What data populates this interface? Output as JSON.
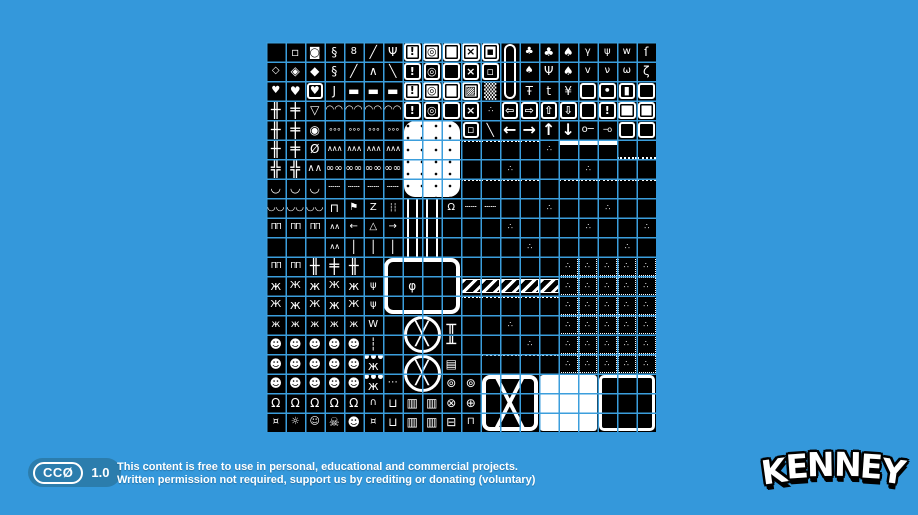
{
  "page": {
    "background_color": "#3498db",
    "sheet_black": "#000000",
    "sheet_white": "#ffffff",
    "gridline_color": "#3b9edc",
    "badge_color": "#2b7dad"
  },
  "license": {
    "badge_cc": "CCØ",
    "badge_version": "1.0",
    "line1": "This content is free to use in personal, educational and commercial projects.",
    "line2": "Written permission not required, support us by crediting or donating (voluntary)"
  },
  "logo": {
    "text": "KENNEY"
  },
  "tilesheet": {
    "description": "1-bit monochrome game tilesheet preview, 20x20 tiles, white pixel art on black with blue grid overlay",
    "grid": {
      "cols": 20,
      "rows": 20,
      "pitch_px": 19.5
    },
    "cross_glyph": "╳",
    "legend": {
      "sq": {
        "ch": "▫"
      },
      "coin": {
        "ch": "◙"
      },
      "chain": {
        "ch": "§"
      },
      "chain2": {
        "ch": "8",
        "cls": "s"
      },
      "ropeL": {
        "ch": "╱"
      },
      "claw": {
        "ch": "Ψ"
      },
      "fwEx": {
        "ch": "!",
        "cls": "fw"
      },
      "fwGear": {
        "ch": "◎",
        "cls": "fw"
      },
      "fwBk": {
        "cls": "fw"
      },
      "fxw": {
        "ch": "×",
        "cls": "fw"
      },
      "fsqW": {
        "ch": "▪",
        "cls": "fw"
      },
      "fbEx": {
        "ch": "!",
        "cls": "fb"
      },
      "fbGear": {
        "ch": "◎",
        "cls": "fb"
      },
      "fbBk": {
        "cls": "fb"
      },
      "fxb": {
        "ch": "×",
        "cls": "fb"
      },
      "fsqB": {
        "ch": "▫",
        "cls": "fb"
      },
      "fhatch": {
        "ch": "▨",
        "cls": "fw"
      },
      "dith": {
        "ch": "▒",
        "cls": "big"
      },
      "capT": {
        "cls": "capt"
      },
      "capM": {
        "cls": "capm"
      },
      "capBt": {
        "cls": "capb"
      },
      "bush": {
        "ch": "♣",
        "cls": "s"
      },
      "treeR": {
        "ch": "♣"
      },
      "treeP": {
        "ch": "♠"
      },
      "pine": {
        "ch": "♠",
        "cls": "s"
      },
      "treeB": {
        "ch": "Ψ"
      },
      "treeT": {
        "ch": "♠"
      },
      "treeD": {
        "ch": "¥"
      },
      "pl1": {
        "ch": "γ",
        "cls": "s"
      },
      "pl2": {
        "ch": "ψ",
        "cls": "s"
      },
      "pl3": {
        "ch": "v",
        "cls": "s"
      },
      "pl4": {
        "ch": "ν",
        "cls": "s"
      },
      "grass": {
        "ch": "w",
        "cls": "s"
      },
      "grass2": {
        "ch": "ω",
        "cls": "s"
      },
      "sap": {
        "ch": "ſ"
      },
      "vine": {
        "ch": "ζ"
      },
      "dia1": {
        "ch": "◇",
        "cls": "s"
      },
      "dia2": {
        "ch": "◈"
      },
      "dia3": {
        "ch": "◆"
      },
      "trusL": {
        "ch": "╱"
      },
      "trusA": {
        "ch": "∧"
      },
      "trusR": {
        "ch": "╲"
      },
      "hrt1": {
        "ch": "♥",
        "cls": "s"
      },
      "hrt2": {
        "ch": "♥"
      },
      "hrt3": {
        "ch": "♥",
        "cls": "fb s"
      },
      "hook": {
        "ch": "J"
      },
      "beam": {
        "ch": "▬"
      },
      "mushT": {
        "ch": "Ŧ"
      },
      "mush": {
        "ch": "t"
      },
      "door": {
        "cls": "fb"
      },
      "doorK": {
        "ch": "•",
        "cls": "fb"
      },
      "doorO": {
        "ch": "▮",
        "cls": "fb s"
      },
      "doorW": {
        "cls": "fb"
      },
      "lad": {
        "ch": "╫",
        "cls": "big"
      },
      "lad2": {
        "ch": "╪",
        "cls": "big"
      },
      "ladB": {
        "ch": "╬",
        "cls": "big"
      },
      "gemD": {
        "ch": "▽"
      },
      "gemO": {
        "ch": "◉"
      },
      "gem0": {
        "ch": "Ø"
      },
      "scalT": {
        "ch": "◠◠",
        "cls": "s"
      },
      "balls": {
        "ch": "∘∘∘",
        "cls": "xs"
      },
      "zig": {
        "ch": "∧∧∧",
        "cls": "xs"
      },
      "oval": {
        "ch": "∞∞",
        "cls": "s"
      },
      "dotln": {
        "ch": "┄┄",
        "cls": "s"
      },
      "scalB": {
        "ch": "◡◡",
        "cls": "s"
      },
      "curve": {
        "ch": "◡"
      },
      "spkM": {
        "ch": "∧∧",
        "cls": "s"
      },
      "spkl": {
        "ch": "∴",
        "cls": "xs"
      },
      "diag": {
        "ch": "╲"
      },
      "signL": {
        "ch": "⇦",
        "cls": "fb"
      },
      "signR": {
        "ch": "⇨",
        "cls": "fb"
      },
      "signU": {
        "ch": "⇧",
        "cls": "fb"
      },
      "signD": {
        "ch": "⇩",
        "cls": "fb"
      },
      "signB": {
        "cls": "fb"
      },
      "signE": {
        "ch": "!",
        "cls": "fb"
      },
      "win": {
        "cls": "fw"
      },
      "arL": {
        "ch": "←",
        "cls": "big"
      },
      "arR": {
        "ch": "→",
        "cls": "big"
      },
      "arU": {
        "ch": "↑",
        "cls": "big"
      },
      "arD": {
        "ch": "↓",
        "cls": "big"
      },
      "key": {
        "ch": "o─",
        "cls": "s"
      },
      "key2": {
        "ch": "─o",
        "cls": "xs"
      },
      "frT": {
        "cls": "fb"
      },
      "sill": {
        "cls": "sill"
      },
      "dt": {
        "cls": "dt"
      },
      "topW": {
        "cls": "topw"
      },
      "haz": {
        "cls": "haz"
      },
      "ore": {
        "ch": "∴",
        "cls": "ore"
      },
      "plat": {
        "ch": "⊓"
      },
      "flag": {
        "ch": "⚑",
        "cls": "s"
      },
      "zplat": {
        "ch": "Z",
        "cls": "s"
      },
      "icic": {
        "ch": "┆┆",
        "cls": "xs"
      },
      "pv": {
        "cls": "pv"
      },
      "bell": {
        "ch": "Ω",
        "cls": "s"
      },
      "fence": {
        "ch": "ΠΠ",
        "cls": "xs"
      },
      "spike": {
        "ch": "∧∧",
        "cls": "xs"
      },
      "signA": {
        "ch": "←",
        "cls": "s"
      },
      "wsign": {
        "ch": "△",
        "cls": "s"
      },
      "signA2": {
        "ch": "→",
        "cls": "s"
      },
      "post": {
        "ch": "│"
      },
      "ptl": {
        "cls": "ptl"
      },
      "pt": {
        "cls": "pt"
      },
      "ptr": {
        "cls": "ptr"
      },
      "pl_": {
        "cls": "psl"
      },
      "pr_": {
        "cls": "psr"
      },
      "pbl": {
        "cls": "pbl"
      },
      "pb": {
        "cls": "pb"
      },
      "pbr": {
        "cls": "pbr"
      },
      "lamp": {
        "ch": "φ"
      },
      "flange": {
        "ch": "╥",
        "cls": "big"
      },
      "flange2": {
        "ch": "╨",
        "cls": "big"
      },
      "sp1": {
        "ch": "ж"
      },
      "sp2": {
        "ch": "Ж",
        "cls": "s"
      },
      "sp3": {
        "ch": "ж",
        "cls": "s"
      },
      "crab": {
        "ch": "ψ",
        "cls": "s"
      },
      "bat": {
        "ch": "W",
        "cls": "s"
      },
      "skull": {
        "ch": "☻"
      },
      "thread": {
        "ch": "┆"
      },
      "jsp": {
        "ch": "ж",
        "cls": "thr"
      },
      "dots3": {
        "ch": "⋯",
        "cls": "s"
      },
      "burger": {
        "ch": "Ω"
      },
      "mound": {
        "ch": "∩",
        "cls": "s"
      },
      "basket": {
        "ch": "⊔"
      },
      "grate": {
        "ch": "▥"
      },
      "wheelX": {
        "ch": "⊗"
      },
      "wheelO": {
        "ch": "⊕"
      },
      "elbow": {
        "ch": "⊚"
      },
      "chest": {
        "ch": "⊟"
      },
      "tabl": {
        "ch": "⊓",
        "cls": "s"
      },
      "vent": {
        "ch": "▤"
      },
      "bug": {
        "ch": "¤",
        "cls": "s"
      },
      "bug2": {
        "ch": "☼",
        "cls": "s"
      },
      "face": {
        "ch": "☺",
        "cls": "s"
      },
      "bones": {
        "ch": "☠"
      },
      "cart": {
        "ch": "⊔"
      }
    },
    "map": [
      [
        "",
        "sq",
        "coin",
        "chain",
        "chain2",
        "ropeL",
        "claw",
        "fwEx",
        "fwGear",
        "fwBk",
        "fxw",
        "fsqW",
        "capT",
        "bush",
        "treeR",
        "treeP",
        "pl1",
        "pl2",
        "grass",
        "sap"
      ],
      [
        "dia1",
        "dia2",
        "dia3",
        "chain",
        "trusL",
        "trusA",
        "trusR",
        "fbEx",
        "fbGear",
        "fbBk",
        "fxb",
        "fsqB",
        "capM",
        "pine",
        "treeB",
        "treeT",
        "pl3",
        "pl4",
        "grass2",
        "vine"
      ],
      [
        "hrt1",
        "hrt2",
        "hrt3",
        "hook",
        "beam",
        "beam",
        "beam",
        "fwEx",
        "fwGear",
        "fwBk",
        "fhatch",
        "dith",
        "capBt",
        "mushT",
        "mush",
        "treeD",
        "door",
        "doorK",
        "doorO",
        "doorW"
      ],
      [
        "lad",
        "lad2",
        "gemD",
        "scalT",
        "scalT",
        "scalT",
        "scalT",
        "fbEx",
        "fbGear",
        "fbBk",
        "fxb",
        "spkl",
        "signL",
        "signR",
        "signU",
        "signD",
        "signB",
        "signE",
        "win",
        "win"
      ],
      [
        "lad",
        "lad2",
        "gemO",
        "balls",
        "balls",
        "balls",
        "balls",
        "",
        "",
        "",
        "fsqB",
        "diag",
        "arL",
        "arR",
        "arU",
        "arD",
        "key",
        "key2",
        "frT",
        "frT"
      ],
      [
        "lad",
        "lad2",
        "gem0",
        "zig",
        "zig",
        "zig",
        "zig",
        "",
        "",
        "",
        "dt",
        "dt",
        "dt",
        "dt",
        "spkl",
        "topW",
        "topW",
        "topW",
        "sill",
        "sill"
      ],
      [
        "ladB",
        "ladB",
        "spkM",
        "oval",
        "oval",
        "oval",
        "oval",
        "",
        "",
        "",
        "",
        "",
        "spkl",
        "",
        "",
        "",
        "spkl",
        "",
        "",
        ""
      ],
      [
        "curve",
        "curve",
        "curve",
        "dotln",
        "dotln",
        "dotln",
        "dotln",
        "",
        "",
        "",
        "dt",
        "dt",
        "dt",
        "dt",
        "",
        "dt",
        "dt",
        "dt",
        "dt",
        "dt"
      ],
      [
        "scalB",
        "scalB",
        "scalB",
        "plat",
        "flag",
        "zplat",
        "icic",
        "pv",
        "pv",
        "bell",
        "dotln",
        "dotln",
        "",
        "",
        "spkl",
        "",
        "",
        "spkl",
        "",
        ""
      ],
      [
        "fence",
        "fence",
        "fence",
        "spike",
        "signA",
        "wsign",
        "signA2",
        "pv",
        "pv",
        "",
        "",
        "",
        "spkl",
        "",
        "",
        "",
        "spkl",
        "",
        "",
        "spkl"
      ],
      [
        "",
        "",
        "",
        "spike",
        "post",
        "post",
        "post",
        "pv",
        "pv",
        "",
        "",
        "",
        "",
        "spkl",
        "",
        "",
        "",
        "",
        "spkl",
        ""
      ],
      [
        "fence",
        "fence",
        "lad",
        "lad2",
        "lad",
        "",
        "ptl",
        "pt",
        "pt",
        "ptr",
        "",
        "",
        "",
        "",
        "",
        "ore",
        "ore",
        "ore",
        "ore",
        "ore"
      ],
      [
        "sp1",
        "sp2",
        "sp1",
        "sp2",
        "sp1",
        "crab",
        "pl_",
        "lamp",
        "",
        "pr_",
        "haz",
        "haz",
        "haz",
        "haz",
        "haz",
        "ore",
        "ore",
        "ore",
        "ore",
        "ore"
      ],
      [
        "sp2",
        "sp1",
        "sp2",
        "sp1",
        "sp2",
        "crab",
        "pbl",
        "pb",
        "pb",
        "pbr",
        "dt",
        "dt",
        "dt",
        "dt",
        "dt",
        "ore",
        "ore",
        "ore",
        "ore",
        "ore"
      ],
      [
        "sp3",
        "sp3",
        "sp3",
        "sp3",
        "sp3",
        "bat",
        "",
        "",
        "",
        "flange",
        "",
        "",
        "spkl",
        "",
        "",
        "ore",
        "ore",
        "ore",
        "ore",
        "ore"
      ],
      [
        "skull",
        "skull",
        "skull",
        "skull",
        "skull",
        "thread",
        "",
        "",
        "",
        "flange2",
        "",
        "",
        "",
        "spkl",
        "",
        "ore",
        "ore",
        "ore",
        "ore",
        "ore"
      ],
      [
        "skull",
        "skull",
        "skull",
        "skull",
        "skull",
        "jsp",
        "",
        "",
        "",
        "vent",
        "",
        "dt",
        "dt",
        "dt",
        "dt",
        "ore",
        "ore",
        "ore",
        "ore",
        "ore"
      ],
      [
        "skull",
        "skull",
        "skull",
        "skull",
        "skull",
        "jsp",
        "dots3",
        "",
        "",
        "elbow",
        "elbow",
        "",
        "",
        "",
        "",
        "",
        "",
        "",
        "",
        ""
      ],
      [
        "burger",
        "burger",
        "burger",
        "burger",
        "burger",
        "mound",
        "basket",
        "grate",
        "grate",
        "wheelX",
        "wheelO",
        "",
        "",
        "",
        "",
        "",
        "",
        "",
        "",
        ""
      ],
      [
        "bug",
        "bug2",
        "face",
        "bones",
        "skull",
        "bug",
        "cart",
        "grate",
        "grate",
        "chest",
        "tabl",
        "",
        "",
        "",
        "",
        "",
        "",
        "",
        "",
        ""
      ]
    ],
    "features": [
      {
        "name": "white-blob",
        "type": "blob",
        "col": 7,
        "row": 4,
        "cols": 3,
        "rows": 4
      },
      {
        "name": "fan-top",
        "type": "fan",
        "col": 7,
        "row": 14,
        "cols": 2,
        "rows": 2
      },
      {
        "name": "fan-bottom",
        "type": "fan",
        "col": 7,
        "row": 16,
        "cols": 2,
        "rows": 2
      },
      {
        "name": "x-crate",
        "type": "xbox",
        "col": 11,
        "row": 17,
        "cols": 3,
        "rows": 3
      },
      {
        "name": "white-square",
        "type": "white",
        "col": 14,
        "row": 17,
        "cols": 3,
        "rows": 3
      },
      {
        "name": "black-square",
        "type": "black",
        "col": 17,
        "row": 17,
        "cols": 3,
        "rows": 3
      }
    ]
  }
}
